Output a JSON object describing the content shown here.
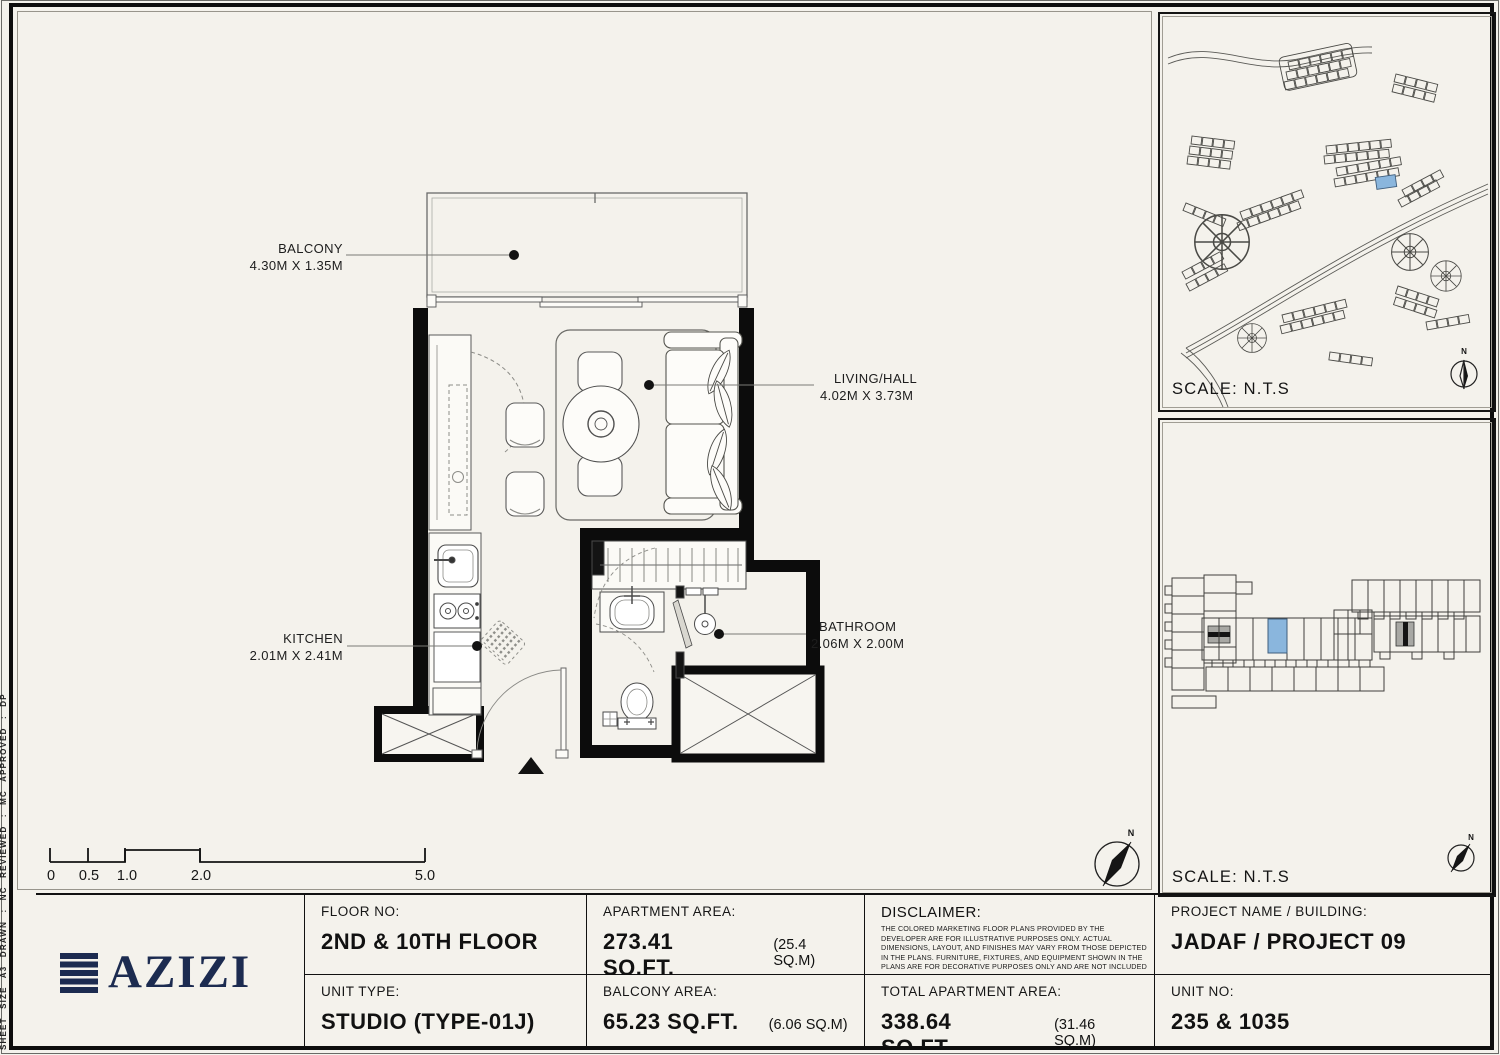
{
  "sheet": {
    "margin_note": "SHEET SIZE A3  DRAWN :  NC  REVIEWED :  MC  APPROVED :  DP",
    "background": "#f4f2ec",
    "accent_blue": "#8ab6dd",
    "logo_navy": "#1c2b50"
  },
  "plan": {
    "rooms": [
      {
        "name": "BALCONY",
        "dims": "4.30M X 1.35M"
      },
      {
        "name": "LIVING/HALL",
        "dims": "4.02M X 3.73M"
      },
      {
        "name": "KITCHEN",
        "dims": "2.01M X 2.41M"
      },
      {
        "name": "BATHROOM",
        "dims": "2.06M X 2.00M"
      }
    ],
    "scale_ticks": [
      "0",
      "0.5",
      "1.0",
      "2.0",
      "5.0"
    ],
    "north_label": "N"
  },
  "panels": {
    "site_map": {
      "scale_label": "SCALE: N.T.S",
      "north_label": "N"
    },
    "building_map": {
      "scale_label": "SCALE: N.T.S",
      "north_label": "N"
    }
  },
  "title_block": {
    "logo_text": "AZIZI",
    "floor_no": {
      "label": "FLOOR NO:",
      "value": "2ND & 10TH FLOOR"
    },
    "unit_type": {
      "label": "UNIT TYPE:",
      "value": "STUDIO (TYPE-01J)"
    },
    "apartment_area": {
      "label": "APARTMENT AREA:",
      "value": "273.41 SQ.FT.",
      "metric": "(25.4 SQ.M)"
    },
    "balcony_area": {
      "label": "BALCONY AREA:",
      "value": "65.23 SQ.FT.",
      "metric": "(6.06 SQ.M)"
    },
    "disclaimer": {
      "label": "DISCLAIMER:",
      "body": "THE COLORED MARKETING FLOOR PLANS PROVIDED BY THE DEVELOPER ARE FOR ILLUSTRATIVE PURPOSES ONLY. ACTUAL DIMENSIONS, LAYOUT, AND FINISHES MAY VARY FROM THOSE DEPICTED IN THE PLANS. FURNITURE, FIXTURES, AND EQUIPMENT SHOWN IN THE PLANS ARE FOR DECORATIVE PURPOSES ONLY AND ARE NOT INCLUDED IN THE PURCHASE OR LEASE OF THE PROPERTY. THE DEVELOPER RESERVES THE RIGHT TO MAKE MODIFICATIONS, REVISIONS, AND CHANGES TO THE FLOOR PLANS, SPECIFICATIONS, AND FEATURES WITHOUT PRIOR NOTICE."
    },
    "total_area": {
      "label": "TOTAL APARTMENT AREA:",
      "value": "338.64 SQ.FT.",
      "metric": "(31.46 SQ.M)"
    },
    "project": {
      "label": "PROJECT NAME / BUILDING:",
      "value": "JADAF / PROJECT 09"
    },
    "unit_no": {
      "label": "UNIT NO:",
      "value": "235 & 1035"
    }
  }
}
